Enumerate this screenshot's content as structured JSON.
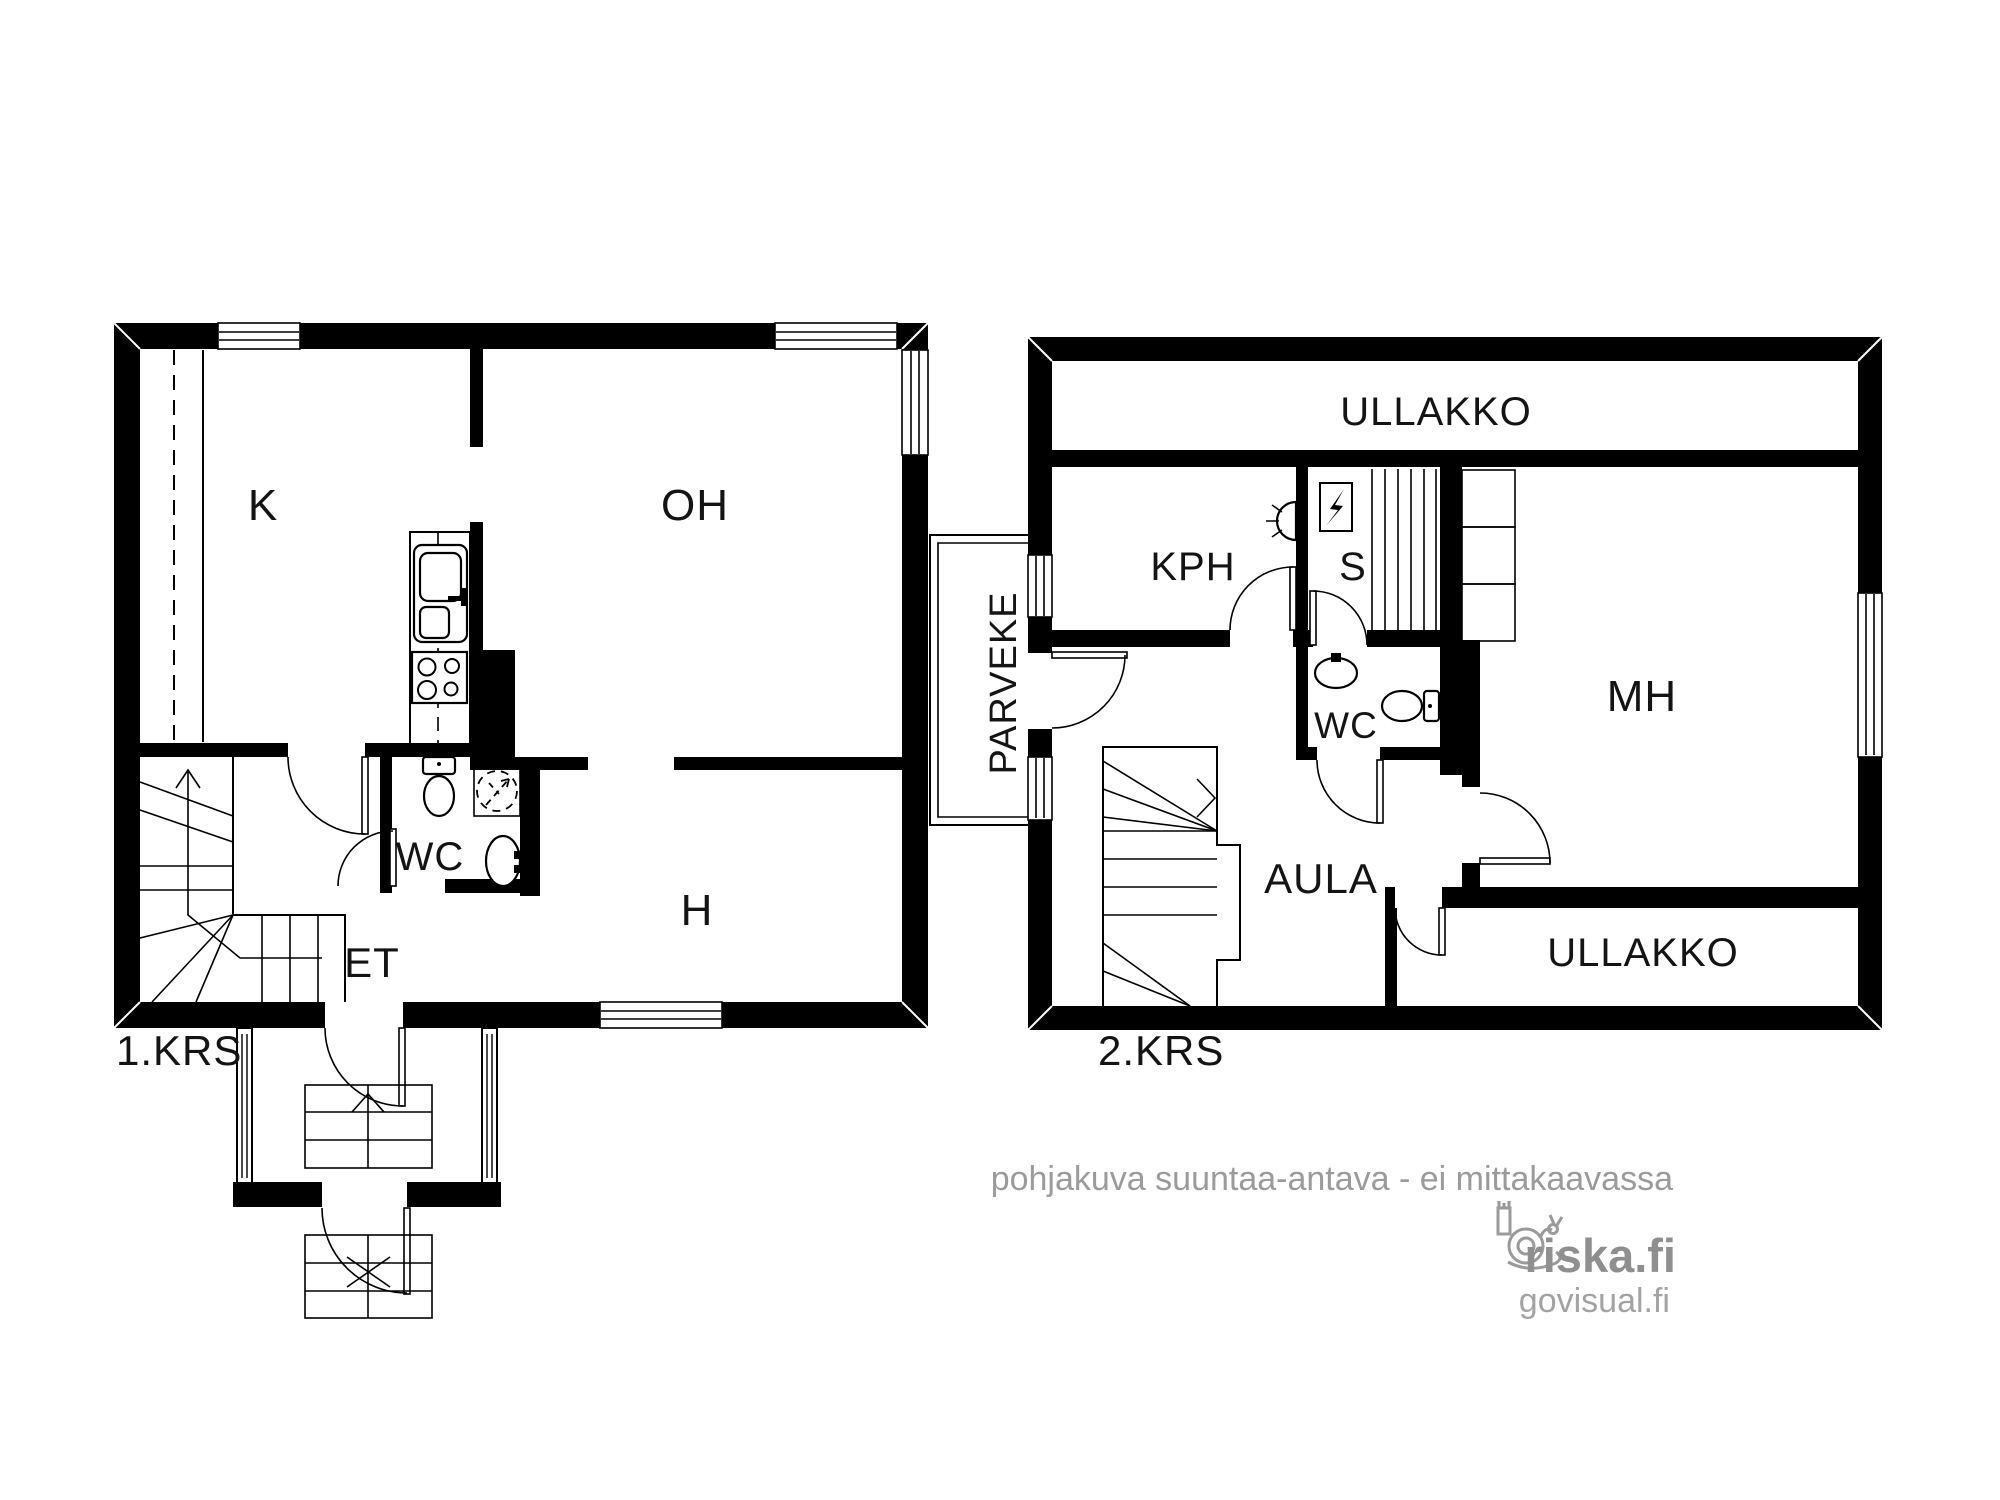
{
  "colors": {
    "ink": "#000000",
    "background": "#ffffff",
    "watermark": "#9a9a9a",
    "brand_gray": "#8f8f8f"
  },
  "floor1": {
    "label": "1.KRS",
    "rooms": {
      "kitchen": "K",
      "living_room": "OH",
      "wc": "WC",
      "room": "H",
      "entry": "ET"
    },
    "fixtures": [
      "kitchen-sink",
      "stove",
      "toilet",
      "washing-machine-reservation",
      "hand-sink",
      "winder-stairs",
      "entry-porch-with-steps"
    ]
  },
  "floor2": {
    "label": "2.KRS",
    "rooms": {
      "attic_top": "ULLAKKO",
      "bathroom": "KPH",
      "sauna": "S",
      "wc": "WC",
      "bedroom": "MH",
      "hall": "AULA",
      "attic_bottom": "ULLAKKO",
      "balcony": "PARVEKE"
    },
    "fixtures": [
      "shower",
      "sauna-heater",
      "sauna-benches",
      "toilet",
      "hand-sink",
      "winder-stairs",
      "wardrobe"
    ]
  },
  "watermark": {
    "disclaimer": "pohjakuva suuntaa-antava - ei mittakaavassa",
    "brand": "riska.fi",
    "subbrand": "govisual.fi"
  }
}
